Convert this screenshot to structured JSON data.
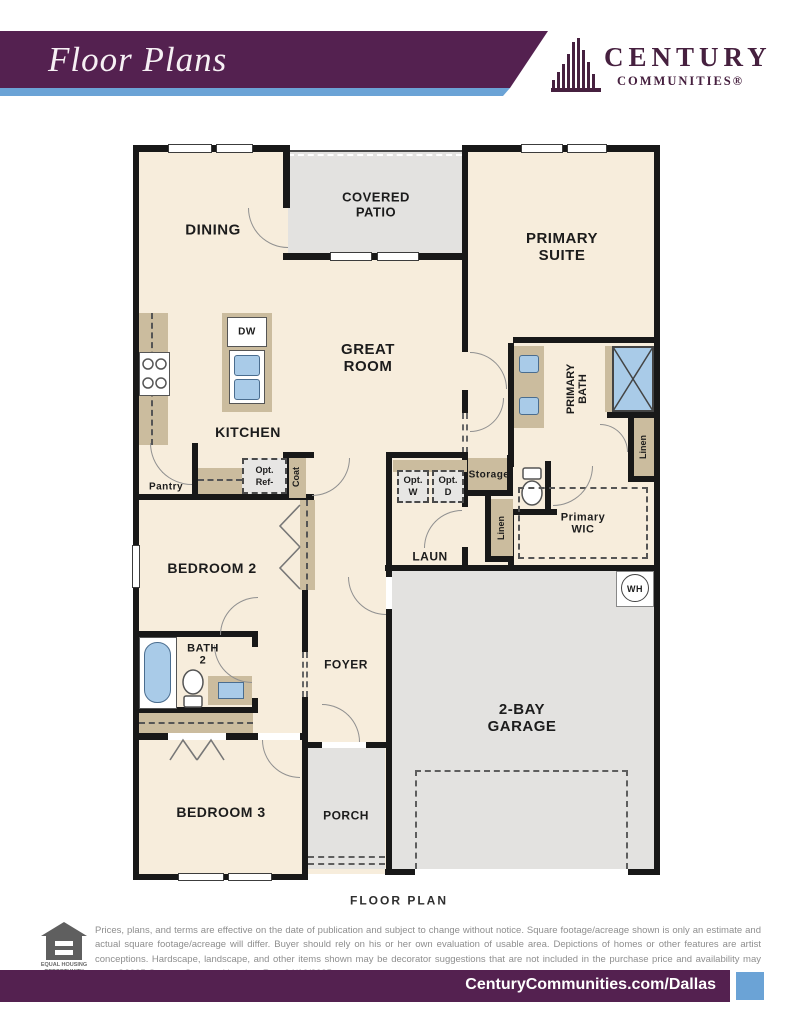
{
  "header": {
    "title": "Floor Plans",
    "brand": "CENTURY",
    "brand_sub": "COMMUNITIES®"
  },
  "plan": {
    "caption": "FLOOR PLAN",
    "labels": {
      "dining": "DINING",
      "covered_patio": "COVERED\nPATIO",
      "primary_suite": "PRIMARY\nSUITE",
      "great_room": "GREAT\nROOM",
      "kitchen": "KITCHEN",
      "pantry": "Pantry",
      "opt_ref": "Opt.\nRef-",
      "coat": "Coat",
      "dw": "DW",
      "storage": "Storage",
      "opt_w": "Opt.\nW",
      "opt_d": "Opt.\nD",
      "laundry": "LAUN",
      "linen_hall": "Linen",
      "linen_bath": "Linen",
      "primary_bath": "PRIMARY\nBATH",
      "primary_wic": "Primary\nWIC",
      "water_heater": "WH",
      "bedroom2": "BEDROOM 2",
      "bath2": "BATH\n2",
      "foyer": "FOYER",
      "bedroom3": "BEDROOM 3",
      "porch": "PORCH",
      "garage": "2-BAY\nGARAGE"
    }
  },
  "footer": {
    "equal_housing": "EQUAL HOUSING\nOPPORTUNITY",
    "disclaimer": "Prices, plans, and terms are effective on the date of publication and subject to change without notice. Square footage/acreage shown is only an estimate and actual square footage/acreage will differ. Buyer should rely on his or her own evaluation of usable area. Depictions of homes or other features are artist conceptions. Hardscape, landscape, and other items shown may be decorator suggestions that are not included in the purchase price and availability may vary. ©2025 Century Communities, Inc. Rev. 04/10/2025",
    "website": "CenturyCommunities.com/Dallas"
  },
  "colors": {
    "banner_purple": "#542150",
    "accent_blue": "#6ba3d6",
    "floor_cream": "#f7eddc",
    "exterior_gray": "#e3e2e0",
    "cabinet_tan": "#cbbc9e",
    "fixture_blue": "#a9cbe8"
  }
}
